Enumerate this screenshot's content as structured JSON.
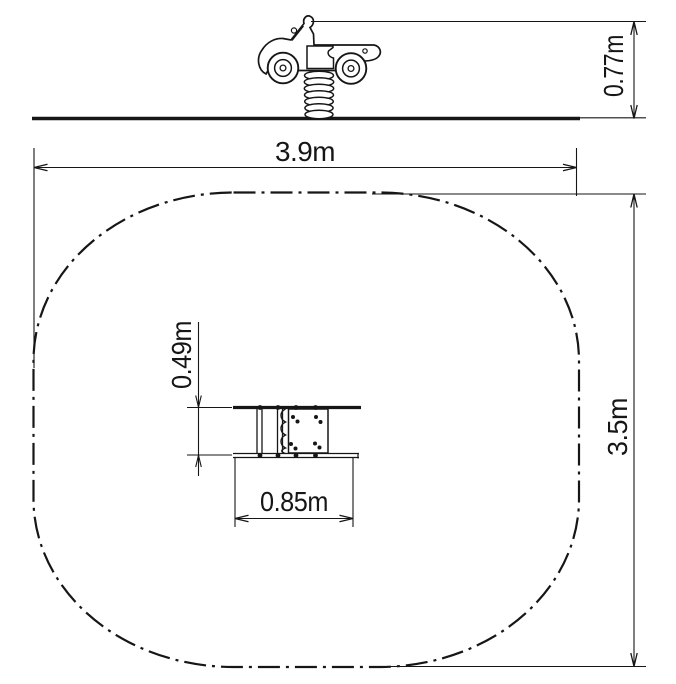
{
  "colors": {
    "background": "#ffffff",
    "ink": "#161616"
  },
  "views": {
    "side": {
      "name": "Spring rider car - side elevation",
      "dimensions": {
        "overall_height": "0.77m"
      }
    },
    "plan": {
      "name": "Safety zone plan view with equipment footprint",
      "dimensions": {
        "safety_zone_width": "3.9m",
        "safety_zone_depth": "3.5m",
        "equipment_width": "0.85m",
        "equipment_depth": "0.49m"
      }
    }
  }
}
